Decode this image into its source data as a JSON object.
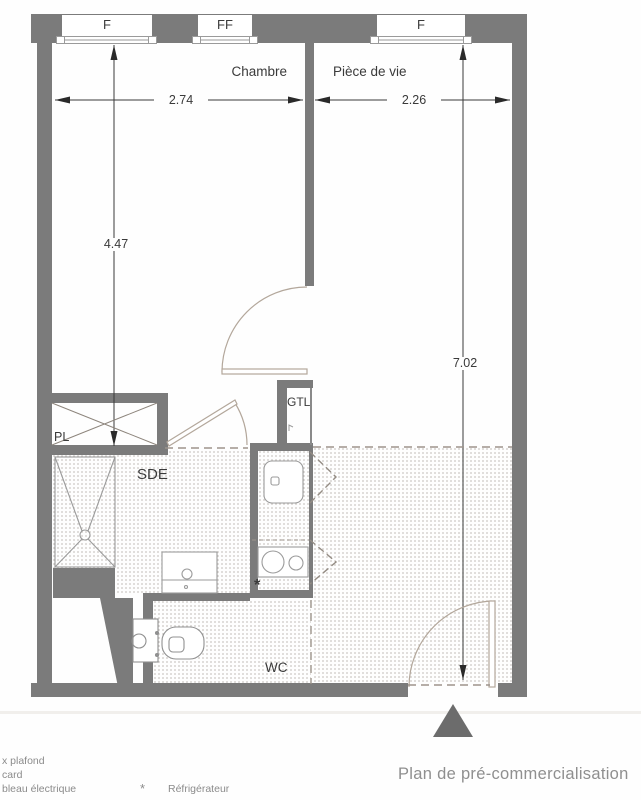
{
  "title": {
    "text": "Plan de pré-commercialisation"
  },
  "plan": {
    "windows": [
      {
        "label": "F"
      },
      {
        "label": "FF"
      },
      {
        "label": "F"
      }
    ],
    "rooms": {
      "chambre": "Chambre",
      "piece_de_vie": "Pièce de vie",
      "sde": "SDE",
      "gtl": "GTL",
      "pl": "PL",
      "wc": "WC"
    },
    "dimensions": {
      "chambre_width": "2.74",
      "piece_width": "2.26",
      "chambre_height": "4.47",
      "piece_height": "7.02"
    },
    "markers": {
      "refrigerator": "*"
    }
  },
  "legend": {
    "items": [
      {
        "label": "x plafond"
      },
      {
        "label": "card"
      },
      {
        "label": "bleau électrique"
      }
    ],
    "refrigerator_symbol": "*",
    "refrigerator_label": "Réfrigérateur"
  },
  "colors": {
    "wall": "#7b7b7b",
    "fixture_line": "#9b9b9b",
    "door_arc": "#b3a79b",
    "dashed_line": "#9d948c",
    "dimension": "#3a3a3a",
    "legend_text": "#8b8b8b",
    "entrance_triangle": "#6c6c6c"
  }
}
